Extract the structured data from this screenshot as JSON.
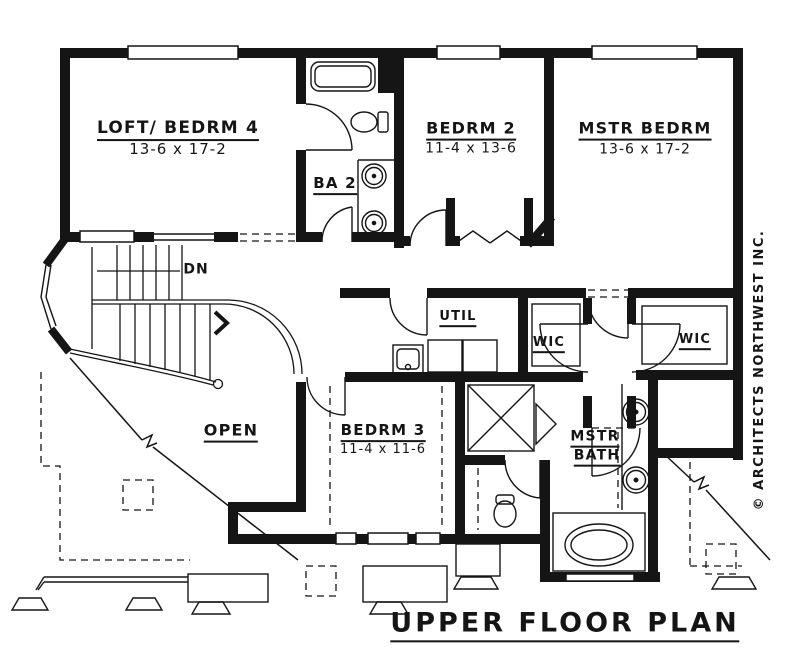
{
  "colors": {
    "ink": "#151515",
    "paper": "#ffffff"
  },
  "plan": {
    "title": "UPPER FLOOR PLAN",
    "credit": "© ARCHITECTS NORTHWEST INC.",
    "stair_note": "DN",
    "rooms": {
      "loft_bedrm4": {
        "name": "LOFT/ BEDRM 4",
        "dims": "13-6 x 17-2"
      },
      "ba2": {
        "name": "BA 2"
      },
      "bedrm2": {
        "name": "BEDRM 2",
        "dims": "11-4 x 13-6"
      },
      "mstr_bedrm": {
        "name": "MSTR BEDRM",
        "dims": "13-6 x 17-2"
      },
      "util": {
        "name": "UTIL"
      },
      "wic_left": {
        "name": "WIC"
      },
      "wic_right": {
        "name": "WIC"
      },
      "bedrm3": {
        "name": "BEDRM 3",
        "dims": "11-4 x 11-6"
      },
      "mstr_bath": {
        "line1": "MSTR",
        "line2": "BATH"
      },
      "open_below": {
        "name": "OPEN"
      }
    }
  }
}
